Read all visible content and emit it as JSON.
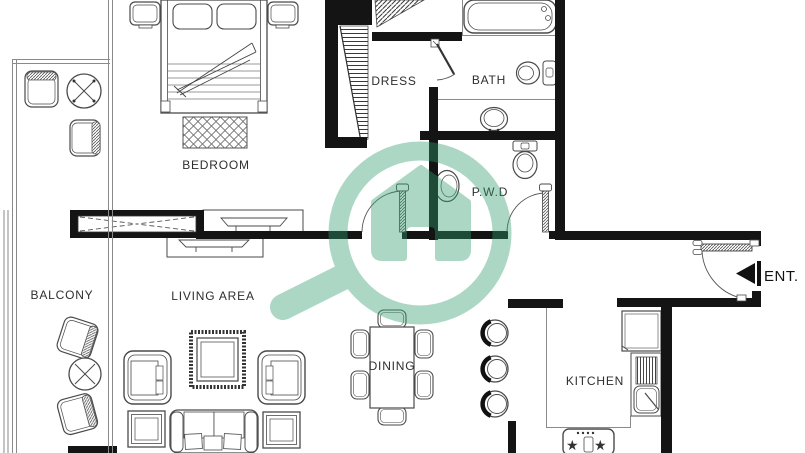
{
  "title": "apartment-floor-plan",
  "colors": {
    "background": "#ffffff",
    "wall": "#141414",
    "line": "#4a4a4a",
    "text": "#2e2e2e",
    "watermark_green": "#2f9e6e"
  },
  "rooms": {
    "bedroom": {
      "label": "BEDROOM"
    },
    "dress": {
      "label": "DRESS"
    },
    "bath": {
      "label": "BATH"
    },
    "pwd": {
      "label": "P.W.D"
    },
    "balcony": {
      "label": "BALCONY"
    },
    "living": {
      "label": "LIVING AREA"
    },
    "dining": {
      "label": "DINING"
    },
    "kitchen": {
      "label": "KITCHEN"
    },
    "entrance": {
      "label": "ENT."
    }
  },
  "fixtures": [
    "double-bed",
    "nightstand",
    "bedroom-rug",
    "sliding-window",
    "tv-console",
    "staircase",
    "bathtub",
    "toilet",
    "wash-basin",
    "powder-room-toilet",
    "powder-room-basin",
    "sofa",
    "armchair",
    "side-table",
    "area-rug",
    "dining-table",
    "dining-chair",
    "bar-stool",
    "refrigerator",
    "kitchen-sink",
    "stove",
    "balcony-chair",
    "balcony-round-table",
    "entry-door"
  ],
  "watermark": {
    "icon": "magnifier-home-icon",
    "color": "#2f9e6e",
    "opacity": 0.4
  }
}
